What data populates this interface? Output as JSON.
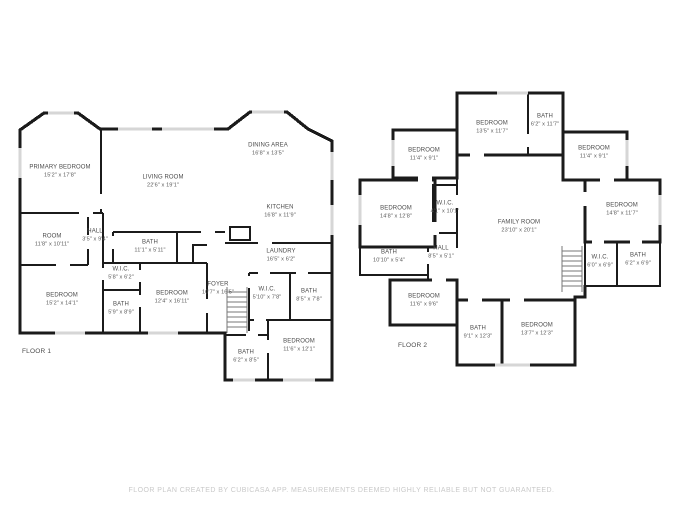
{
  "floor1": {
    "label": "FLOOR 1",
    "rooms": [
      {
        "name": "PRIMARY BEDROOM",
        "dims": "15'2\" x 17'8\""
      },
      {
        "name": "LIVING ROOM",
        "dims": "22'6\" x 19'1\""
      },
      {
        "name": "DINING AREA",
        "dims": "16'8\" x 13'5\""
      },
      {
        "name": "KITCHEN",
        "dims": "16'8\" x 11'9\""
      },
      {
        "name": "ROOM",
        "dims": "11'8\" x 10'11\""
      },
      {
        "name": "HALL",
        "dims": "3'5\" x 9'4\""
      },
      {
        "name": "BATH",
        "dims": "11'1\" x 5'11\""
      },
      {
        "name": "W.I.C.",
        "dims": "5'8\" x 6'2\""
      },
      {
        "name": "BATH",
        "dims": "5'9\" x 8'9\""
      },
      {
        "name": "BEDROOM",
        "dims": "15'2\" x 14'1\""
      },
      {
        "name": "BEDROOM",
        "dims": "12'4\" x 16'11\""
      },
      {
        "name": "LAUNDRY",
        "dims": "16'5\" x 6'2\""
      },
      {
        "name": "FOYER",
        "dims": "10'7\" x 16'5\""
      },
      {
        "name": "W.I.C.",
        "dims": "5'10\" x 7'8\""
      },
      {
        "name": "BATH",
        "dims": "8'5\" x 7'8\""
      },
      {
        "name": "BATH",
        "dims": "6'2\" x 8'5\""
      },
      {
        "name": "BEDROOM",
        "dims": "11'6\" x 12'1\""
      }
    ]
  },
  "floor2": {
    "label": "FLOOR 2",
    "rooms": [
      {
        "name": "BEDROOM",
        "dims": "13'5\" x 11'7\""
      },
      {
        "name": "BATH",
        "dims": "6'2\" x 11'7\""
      },
      {
        "name": "BEDROOM",
        "dims": "11'4\" x 9'1\""
      },
      {
        "name": "BEDROOM",
        "dims": "11'4\" x 9'1\""
      },
      {
        "name": "BEDROOM",
        "dims": "14'8\" x 12'8\""
      },
      {
        "name": "W.I.C.",
        "dims": "4'1\" x 10'1\""
      },
      {
        "name": "FAMILY ROOM",
        "dims": "23'10\" x 20'1\""
      },
      {
        "name": "BEDROOM",
        "dims": "14'8\" x 11'7\""
      },
      {
        "name": "BATH",
        "dims": "10'10\" x 5'4\""
      },
      {
        "name": "HALL",
        "dims": "8'5\" x 5'1\""
      },
      {
        "name": "W.I.C.",
        "dims": "6'0\" x 6'9\""
      },
      {
        "name": "BATH",
        "dims": "6'2\" x 6'9\""
      },
      {
        "name": "BEDROOM",
        "dims": "11'6\" x 9'6\""
      },
      {
        "name": "BATH",
        "dims": "9'1\" x 12'3\""
      },
      {
        "name": "BEDROOM",
        "dims": "13'7\" x 12'3\""
      }
    ]
  },
  "footer": {
    "text": "FLOOR PLAN CREATED BY CUBICASA APP. MEASUREMENTS DEEMED HIGHLY RELIABLE BUT NOT GUARANTEED."
  },
  "colors": {
    "wall": "#1b1b1b",
    "window": "#d6d6d6",
    "stairs": "#777777",
    "label_text": "#4c4c4c",
    "footer_text": "#c9c9c9"
  }
}
